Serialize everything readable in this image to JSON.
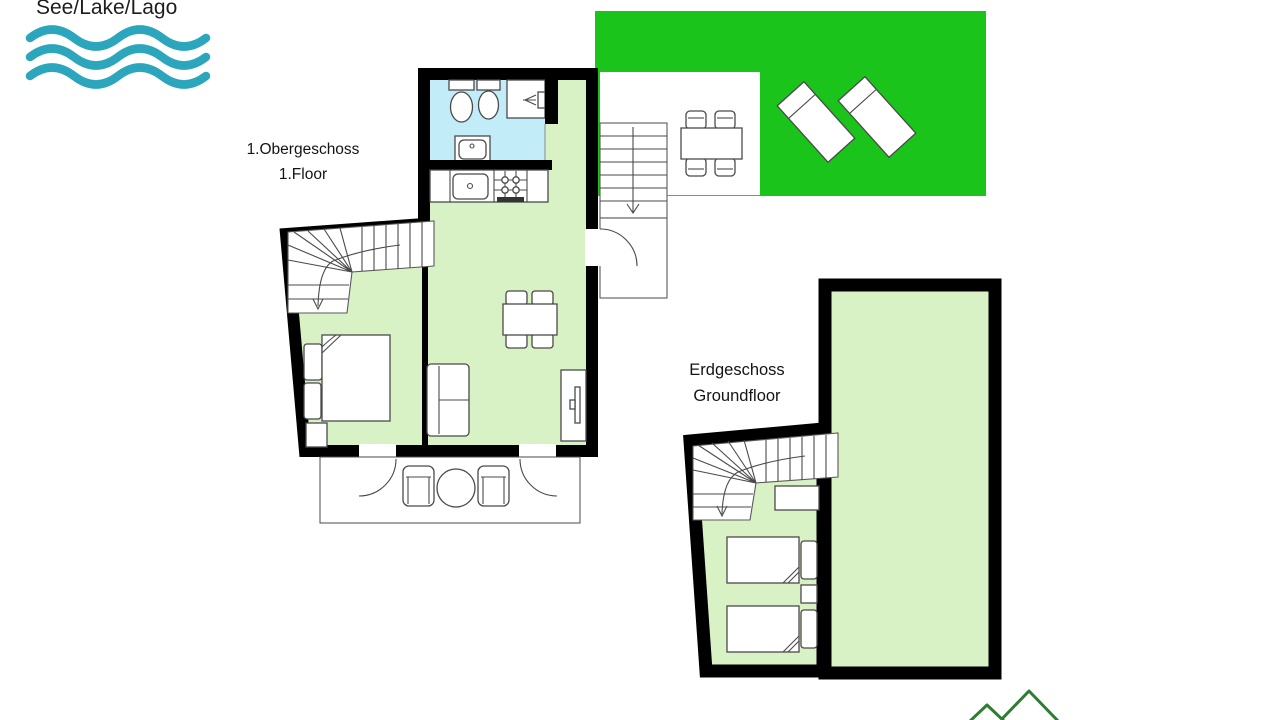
{
  "page": {
    "width": 1280,
    "height": 720,
    "background": "#ffffff"
  },
  "lake_area": {
    "label": "See/Lake/Lago",
    "icon": "waves-icon"
  },
  "floor_labels": {
    "upper": {
      "line1": "1.Obergeschoss",
      "line2": "1.Floor"
    },
    "ground": {
      "line1": "Erdgeschoss",
      "line2": "Groundfloor"
    }
  },
  "colors": {
    "wall": "#000000",
    "room_fill": "#d9f2c5",
    "bathroom_fill": "#c2ecf8",
    "lawn_green": "#1bc41b",
    "outline": "#4a4a4a",
    "wave_teal": "#2BA6BC",
    "tree_green": "#2e7d32"
  },
  "upper_floor": {
    "rooms": [
      "bathroom",
      "kitchen",
      "living-dining-room",
      "bedroom",
      "balcony",
      "entry-landing"
    ],
    "furniture": [
      "toilet",
      "bidet",
      "shower",
      "washbasin",
      "kitchen-sink",
      "stove",
      "dining-table-with-4-chairs",
      "sofa",
      "tv-on-sideboard",
      "double-bed",
      "nightstand",
      "winder-staircase",
      "balcony-round-table",
      "balcony-chairs",
      "entry-door",
      "balcony-doors",
      "outdoor-staircase-with-down-arrow"
    ]
  },
  "ground_floor": {
    "rooms": [
      "bedroom",
      "garden-room"
    ],
    "furniture": [
      "winder-staircase-with-down-arrow",
      "wardrobe",
      "single-bed-1",
      "single-bed-2",
      "nightstand"
    ]
  },
  "outdoor": {
    "features": [
      "lawn",
      "patio",
      "garden-table-with-4-chairs",
      "sun-lounger-1",
      "sun-lounger-2",
      "fir-trees"
    ]
  }
}
